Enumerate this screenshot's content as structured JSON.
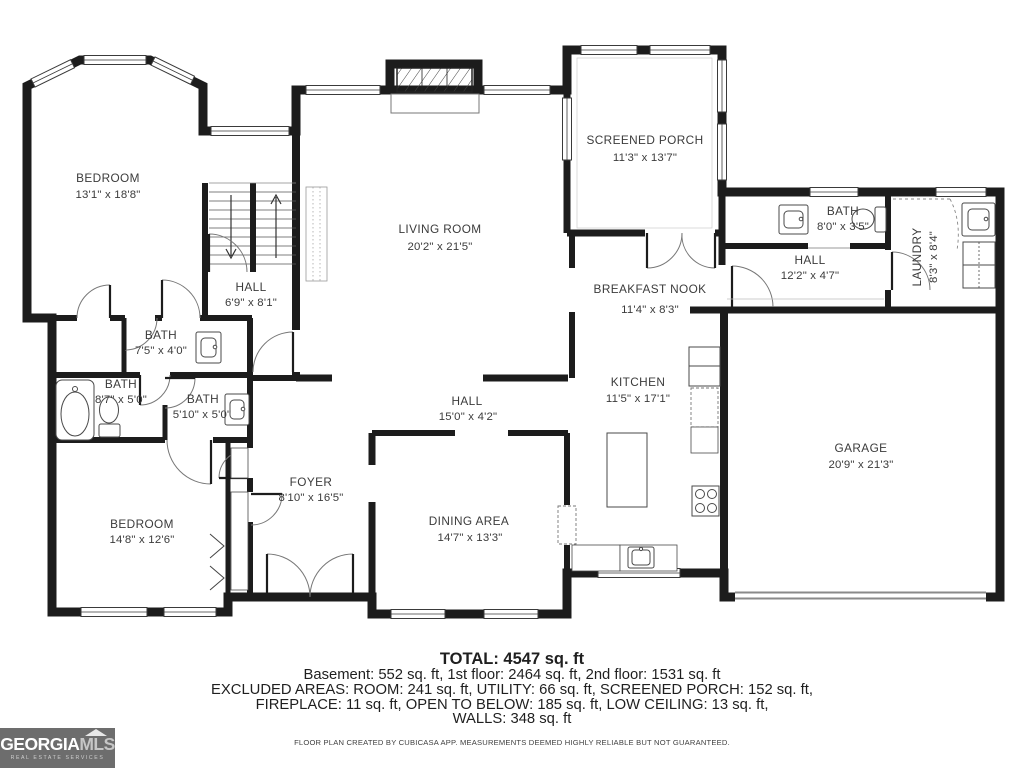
{
  "rooms": {
    "bedroom1": {
      "name": "BEDROOM",
      "dims": "13'1\" x 18'8\""
    },
    "living_room": {
      "name": "LIVING ROOM",
      "dims": "20'2\" x 21'5\""
    },
    "screened_porch": {
      "name": "SCREENED PORCH",
      "dims": "11'3\" x 13'7\""
    },
    "bath_top_right": {
      "name": "BATH",
      "dims": "8'0\" x 3'5\""
    },
    "hall_right": {
      "name": "HALL",
      "dims": "12'2\" x 4'7\""
    },
    "laundry": {
      "name": "LAUNDRY",
      "dims": "8'3\" x 8'4\""
    },
    "hall_stairs": {
      "name": "HALL",
      "dims": "6'9\" x 8'1\""
    },
    "bath_small": {
      "name": "BATH",
      "dims": "7'5\" x 4'0\""
    },
    "breakfast_nook": {
      "name": "BREAKFAST NOOK",
      "dims": "11'4\" x 8'3\""
    },
    "kitchen": {
      "name": "KITCHEN",
      "dims": "11'5\" x 17'1\""
    },
    "bath_tub": {
      "name": "BATH",
      "dims": "8'7\" x 5'0\""
    },
    "bath_mid": {
      "name": "BATH",
      "dims": "5'10\" x 5'0\""
    },
    "hall_center": {
      "name": "HALL",
      "dims": "15'0\" x 4'2\""
    },
    "garage": {
      "name": "GARAGE",
      "dims": "20'9\" x 21'3\""
    },
    "foyer": {
      "name": "FOYER",
      "dims": "8'10\" x 16'5\""
    },
    "bedroom2": {
      "name": "BEDROOM",
      "dims": "14'8\" x 12'6\""
    },
    "dining": {
      "name": "DINING AREA",
      "dims": "14'7\" x 13'3\""
    }
  },
  "summary": {
    "total": "TOTAL: 4547 sq. ft",
    "line1": "Basement: 552 sq. ft, 1st floor: 2464 sq. ft, 2nd floor: 1531 sq. ft",
    "line2": "EXCLUDED AREAS: ROOM: 241 sq. ft, UTILITY: 66 sq. ft, SCREENED PORCH: 152 sq. ft,",
    "line3": "FIREPLACE: 11 sq. ft, OPEN TO BELOW: 185 sq. ft, LOW CEILING: 13 sq. ft,",
    "line4": "WALLS: 348 sq. ft",
    "disclaimer": "FLOOR PLAN CREATED BY CUBICASA APP. MEASUREMENTS DEEMED HIGHLY RELIABLE BUT NOT GUARANTEED."
  },
  "logo": {
    "brand_primary": "GEORGIA",
    "brand_secondary": "MLS",
    "tagline": "REAL ESTATE SERVICES"
  },
  "colors": {
    "wall": "#1c1c1c",
    "label_text": "#3b3b3b",
    "logo_bg": "#6d6d6d"
  }
}
